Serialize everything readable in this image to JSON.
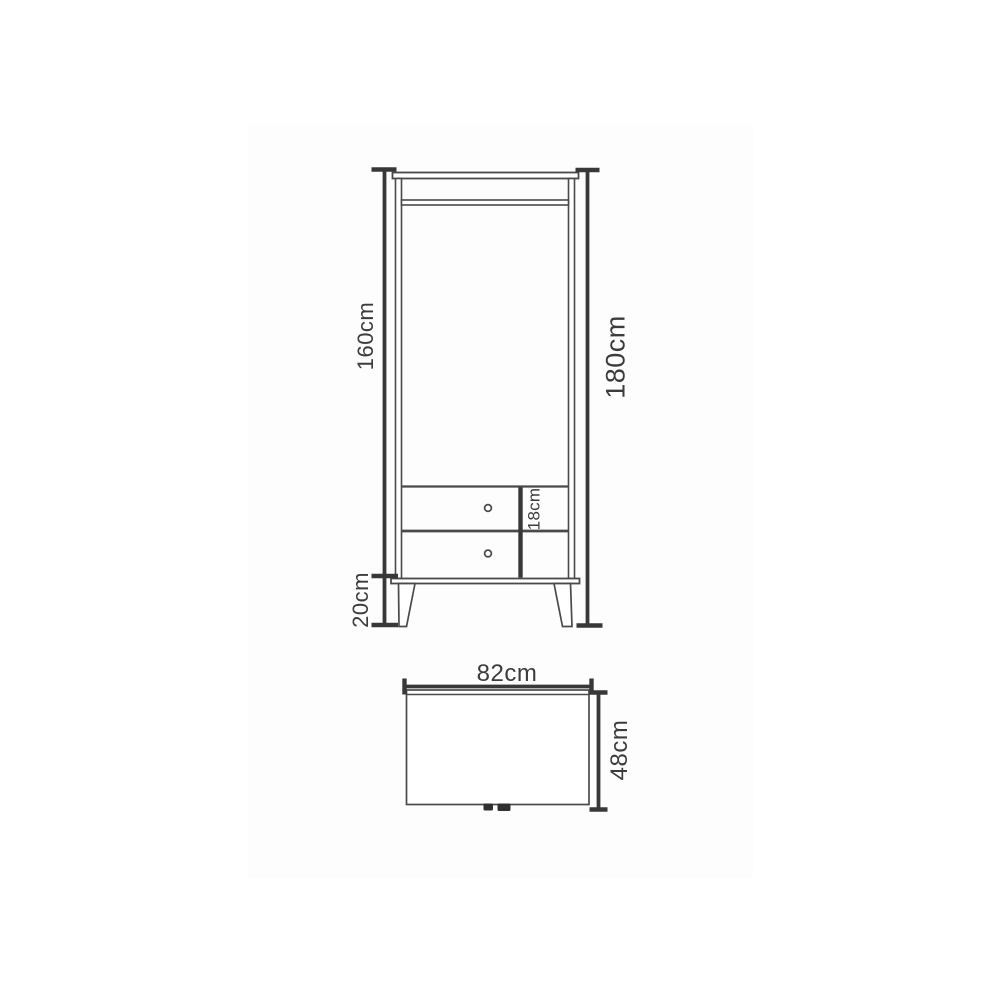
{
  "colors": {
    "page_background": "#ffffff",
    "image_canvas": "#fdfdfd",
    "furniture_line": "#4a4a4a",
    "dimension_line": "#383838",
    "label_text": "#3c3c3c",
    "foot_mark": "#303030"
  },
  "front_view": {
    "labels": {
      "body_height": "160cm",
      "total_height": "180cm",
      "leg_height": "20cm",
      "drawer_height": "18cm"
    }
  },
  "top_view": {
    "labels": {
      "width": "82cm",
      "depth": "48cm"
    }
  }
}
